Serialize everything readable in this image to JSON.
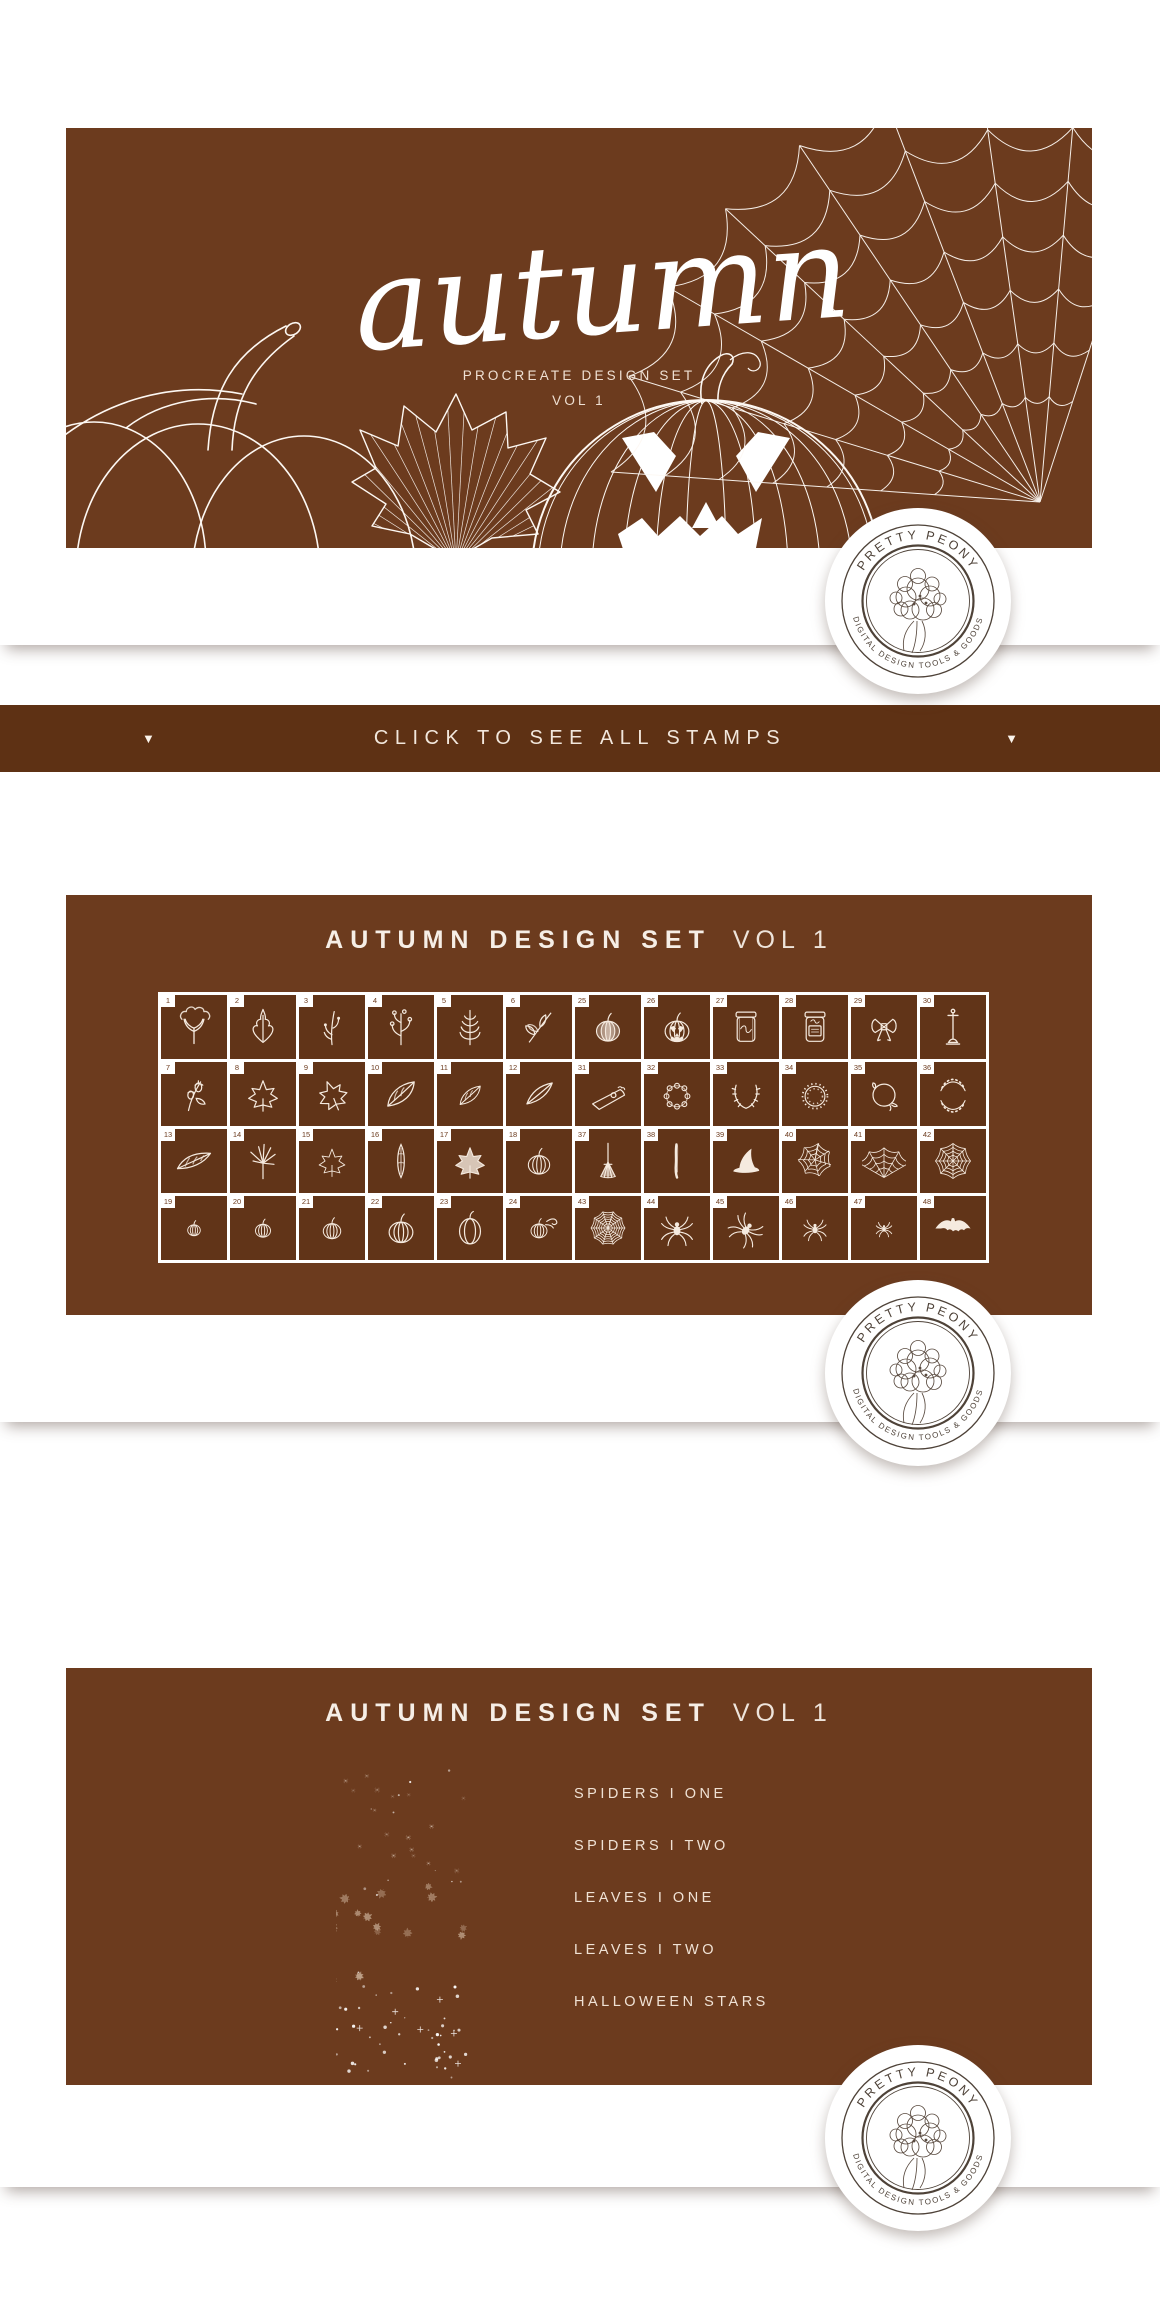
{
  "hero": {
    "script_title": "autumn",
    "subtitle_line1": "PROCREATE DESIGN SET",
    "subtitle_line2": "VOL 1"
  },
  "badge": {
    "top_text": "PRETTY PEONY",
    "bottom_text": "DIGITAL DESIGN TOOLS & GOODS"
  },
  "stamps_bar": {
    "label": "CLICK TO SEE ALL STAMPS",
    "left_arrow": "▼",
    "right_arrow": "▼"
  },
  "grid_section": {
    "title_strong": "AUTUMN DESIGN SET",
    "title_light": "VOL 1",
    "cells": [
      {
        "n": "1",
        "icon": "tree"
      },
      {
        "n": "2",
        "icon": "oak-leaf"
      },
      {
        "n": "3",
        "icon": "sprig"
      },
      {
        "n": "4",
        "icon": "berry-branch"
      },
      {
        "n": "5",
        "icon": "fern"
      },
      {
        "n": "6",
        "icon": "leafy-branch"
      },
      {
        "n": "25",
        "icon": "pumpkin-textured"
      },
      {
        "n": "26",
        "icon": "jack-o-lantern"
      },
      {
        "n": "27",
        "icon": "mason-jar"
      },
      {
        "n": "28",
        "icon": "mason-jar-label"
      },
      {
        "n": "29",
        "icon": "bow"
      },
      {
        "n": "30",
        "icon": "lamp-post"
      },
      {
        "n": "7",
        "icon": "acorn-branch"
      },
      {
        "n": "8",
        "icon": "maple-leaf"
      },
      {
        "n": "9",
        "icon": "maple-leaf-2"
      },
      {
        "n": "10",
        "icon": "leaf"
      },
      {
        "n": "11",
        "icon": "leaf-sm"
      },
      {
        "n": "12",
        "icon": "leaf-slim"
      },
      {
        "n": "31",
        "icon": "pie-slice"
      },
      {
        "n": "32",
        "icon": "wreath-floral"
      },
      {
        "n": "33",
        "icon": "laurel-open"
      },
      {
        "n": "34",
        "icon": "wreath-foliage"
      },
      {
        "n": "35",
        "icon": "wreath-vine"
      },
      {
        "n": "36",
        "icon": "laurel-double"
      },
      {
        "n": "13",
        "icon": "long-leaf"
      },
      {
        "n": "14",
        "icon": "jp-maple"
      },
      {
        "n": "15",
        "icon": "maple-outline"
      },
      {
        "n": "16",
        "icon": "seed-pod"
      },
      {
        "n": "17",
        "icon": "maple-filled"
      },
      {
        "n": "18",
        "icon": "pumpkin-outline"
      },
      {
        "n": "37",
        "icon": "broom"
      },
      {
        "n": "38",
        "icon": "broom-stick"
      },
      {
        "n": "39",
        "icon": "witch-hat"
      },
      {
        "n": "40",
        "icon": "web-messy"
      },
      {
        "n": "41",
        "icon": "cobweb"
      },
      {
        "n": "42",
        "icon": "web-round"
      },
      {
        "n": "19",
        "icon": "pumpkin-xs"
      },
      {
        "n": "20",
        "icon": "pumpkin-sm"
      },
      {
        "n": "21",
        "icon": "pumpkin-md"
      },
      {
        "n": "22",
        "icon": "pumpkin-lg"
      },
      {
        "n": "23",
        "icon": "pumpkin-tall"
      },
      {
        "n": "24",
        "icon": "pumpkin-vine"
      },
      {
        "n": "43",
        "icon": "web-dense"
      },
      {
        "n": "44",
        "icon": "spider"
      },
      {
        "n": "45",
        "icon": "spider-2"
      },
      {
        "n": "46",
        "icon": "spider-sm"
      },
      {
        "n": "47",
        "icon": "spider-tiny"
      },
      {
        "n": "48",
        "icon": "bat"
      }
    ]
  },
  "brushes_section": {
    "title_strong": "AUTUMN DESIGN SET",
    "title_light": "VOL 1",
    "items": [
      "SPIDERS I ONE",
      "SPIDERS I TWO",
      "LEAVES I ONE",
      "LEAVES I TWO",
      "HALLOWEEN STARS"
    ]
  },
  "colors": {
    "panel_brown": "#6C3B1E",
    "cell_brown": "#613418",
    "bar_brown": "#5E3114",
    "stamp_ink": "#F5EADF",
    "badge_ink": "#4E4238"
  }
}
